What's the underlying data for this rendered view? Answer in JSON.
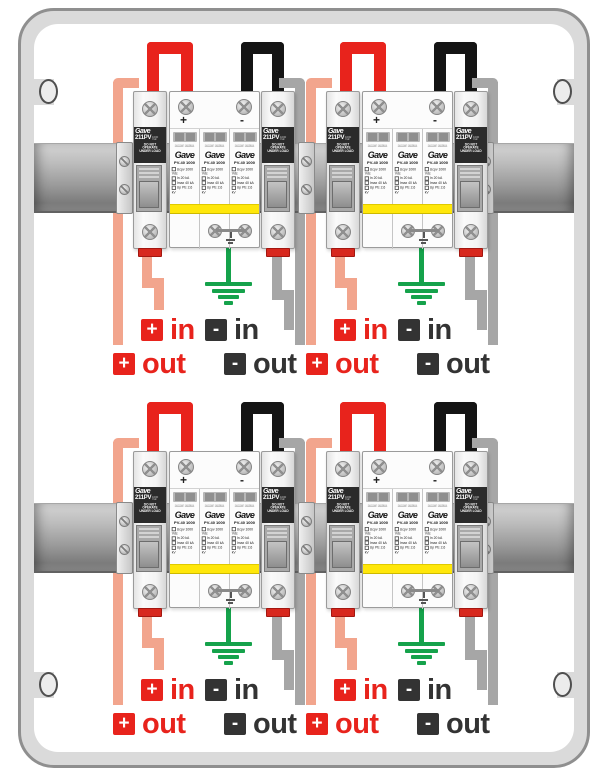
{
  "diagram": {
    "breaker": {
      "brand": "Gave",
      "model": "211PV",
      "rating_line1": "1000",
      "rating_line2": "Vdc",
      "warning": "DO NOT OPERATE UNDER LOAD"
    },
    "spd": {
      "brand": "Gave",
      "model": "PV-40 1000",
      "status_left": "normal",
      "status_right": "replace",
      "specs": [
        "Ucpv 1000 Vdc",
        "In 20 kA",
        "Imax 40 kA",
        "Up PE 2,6 kV"
      ],
      "plus_terminal": "+",
      "minus_terminal": "-"
    },
    "labels": {
      "plus": "+",
      "minus": "-",
      "in": "in",
      "out": "out"
    },
    "colors": {
      "positive_wire": "#e8231c",
      "positive_feed_wire": "#f2a58d",
      "negative_wire": "#141414",
      "negative_feed_wire": "#a6a6a6",
      "ground_wire": "#15a24b",
      "spd_band": "#ffe70a"
    }
  }
}
